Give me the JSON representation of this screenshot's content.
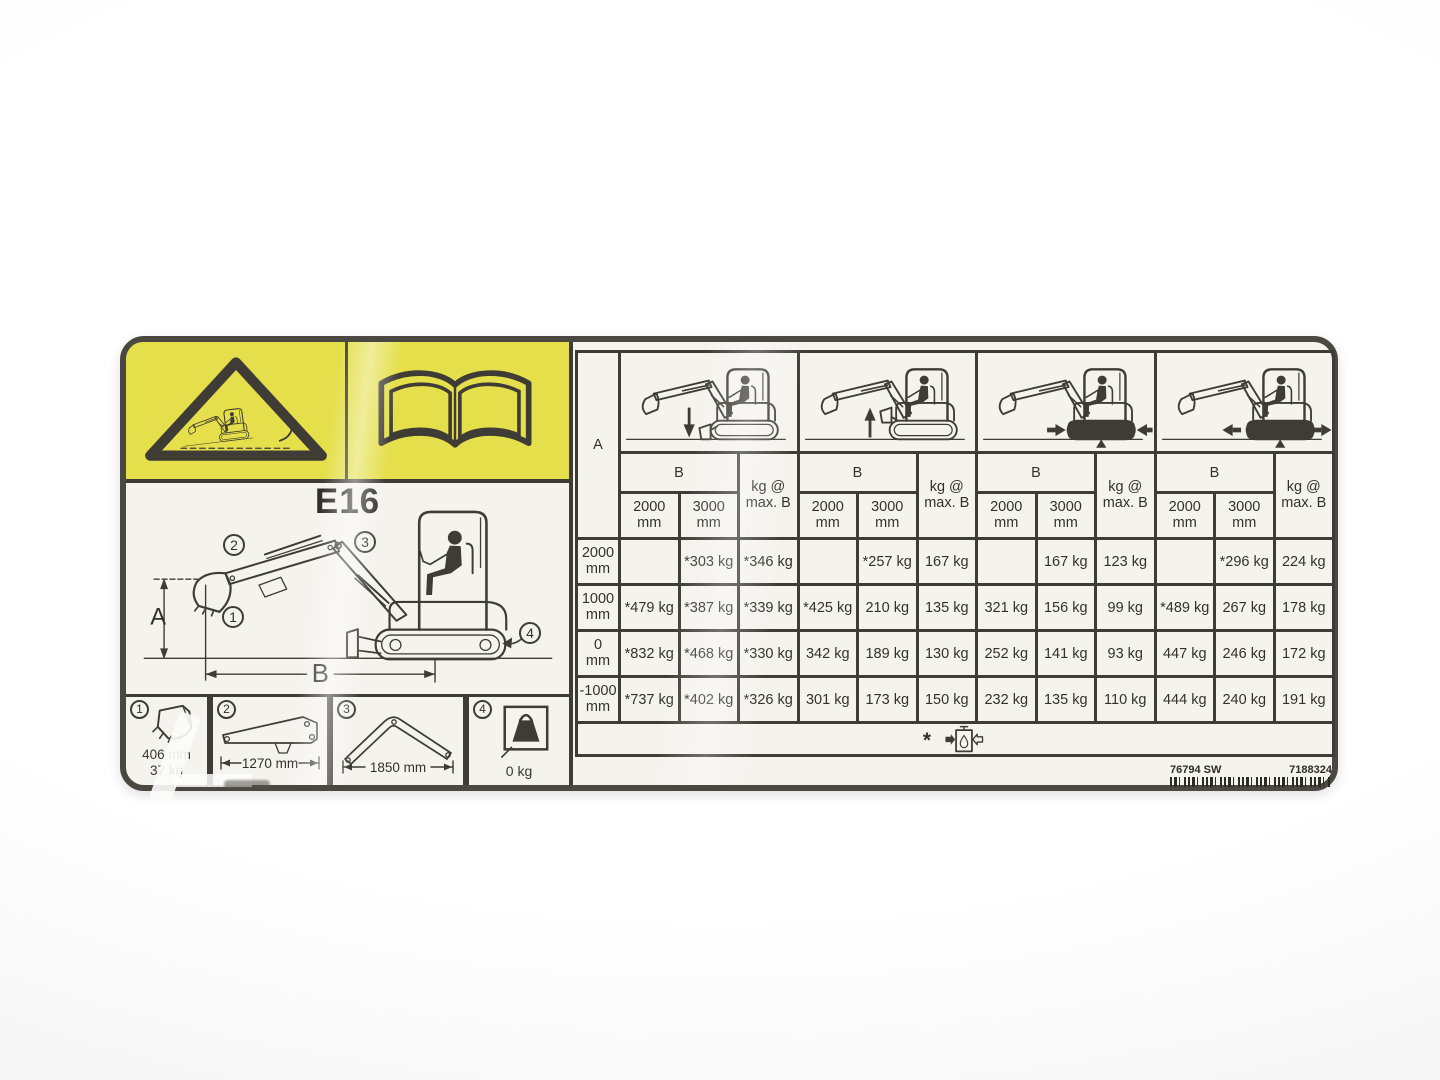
{
  "colors": {
    "warning_yellow": "#e4df4a",
    "line_dark": "#3f3b35",
    "label_bg": "#f5f3ee",
    "text": "#35312a"
  },
  "label": {
    "model": "E16",
    "diagram": {
      "dim_a": "A",
      "dim_b": "B",
      "callouts": [
        "1",
        "2",
        "3",
        "4"
      ]
    },
    "components": [
      {
        "num": "1",
        "size": "406 mm",
        "weight": "37 kg"
      },
      {
        "num": "2",
        "size": "1270 mm"
      },
      {
        "num": "3",
        "size": "1850 mm"
      },
      {
        "num": "4",
        "weight": "0 kg"
      }
    ],
    "table": {
      "a_header": "A",
      "b_header": "B",
      "kg_header_line1": "kg @",
      "kg_header_line2": "max. B",
      "reach_cols": [
        {
          "l1": "2000",
          "l2": "mm"
        },
        {
          "l1": "3000",
          "l2": "mm"
        }
      ],
      "row_headers": [
        {
          "l1": "2000",
          "l2": "mm"
        },
        {
          "l1": "1000",
          "l2": "mm"
        },
        {
          "l1": "0",
          "l2": "mm"
        },
        {
          "l1": "-1000",
          "l2": "mm"
        }
      ],
      "groups": [
        {
          "config": "blade-down",
          "rows": [
            [
              "",
              "*303 kg",
              "*346 kg"
            ],
            [
              "*479 kg",
              "*387 kg",
              "*339 kg"
            ],
            [
              "*832 kg",
              "*468 kg",
              "*330 kg"
            ],
            [
              "*737 kg",
              "*402 kg",
              "*326 kg"
            ]
          ]
        },
        {
          "config": "blade-up",
          "rows": [
            [
              "",
              "*257 kg",
              "167 kg"
            ],
            [
              "*425 kg",
              "210 kg",
              "135 kg"
            ],
            [
              "342 kg",
              "189 kg",
              "130 kg"
            ],
            [
              "301 kg",
              "173 kg",
              "150 kg"
            ]
          ]
        },
        {
          "config": "tracks-retracted",
          "rows": [
            [
              "",
              "167 kg",
              "123 kg"
            ],
            [
              "321 kg",
              "156 kg",
              "99 kg"
            ],
            [
              "252 kg",
              "141 kg",
              "93 kg"
            ],
            [
              "232 kg",
              "135 kg",
              "110 kg"
            ]
          ]
        },
        {
          "config": "tracks-extended",
          "rows": [
            [
              "",
              "*296 kg",
              "224 kg"
            ],
            [
              "*489 kg",
              "267 kg",
              "178 kg"
            ],
            [
              "447 kg",
              "246 kg",
              "172 kg"
            ],
            [
              "444 kg",
              "240 kg",
              "191 kg"
            ]
          ]
        }
      ],
      "footnote_star": "*"
    },
    "part_numbers": {
      "left": "76794 SW",
      "right": "7188324"
    }
  }
}
